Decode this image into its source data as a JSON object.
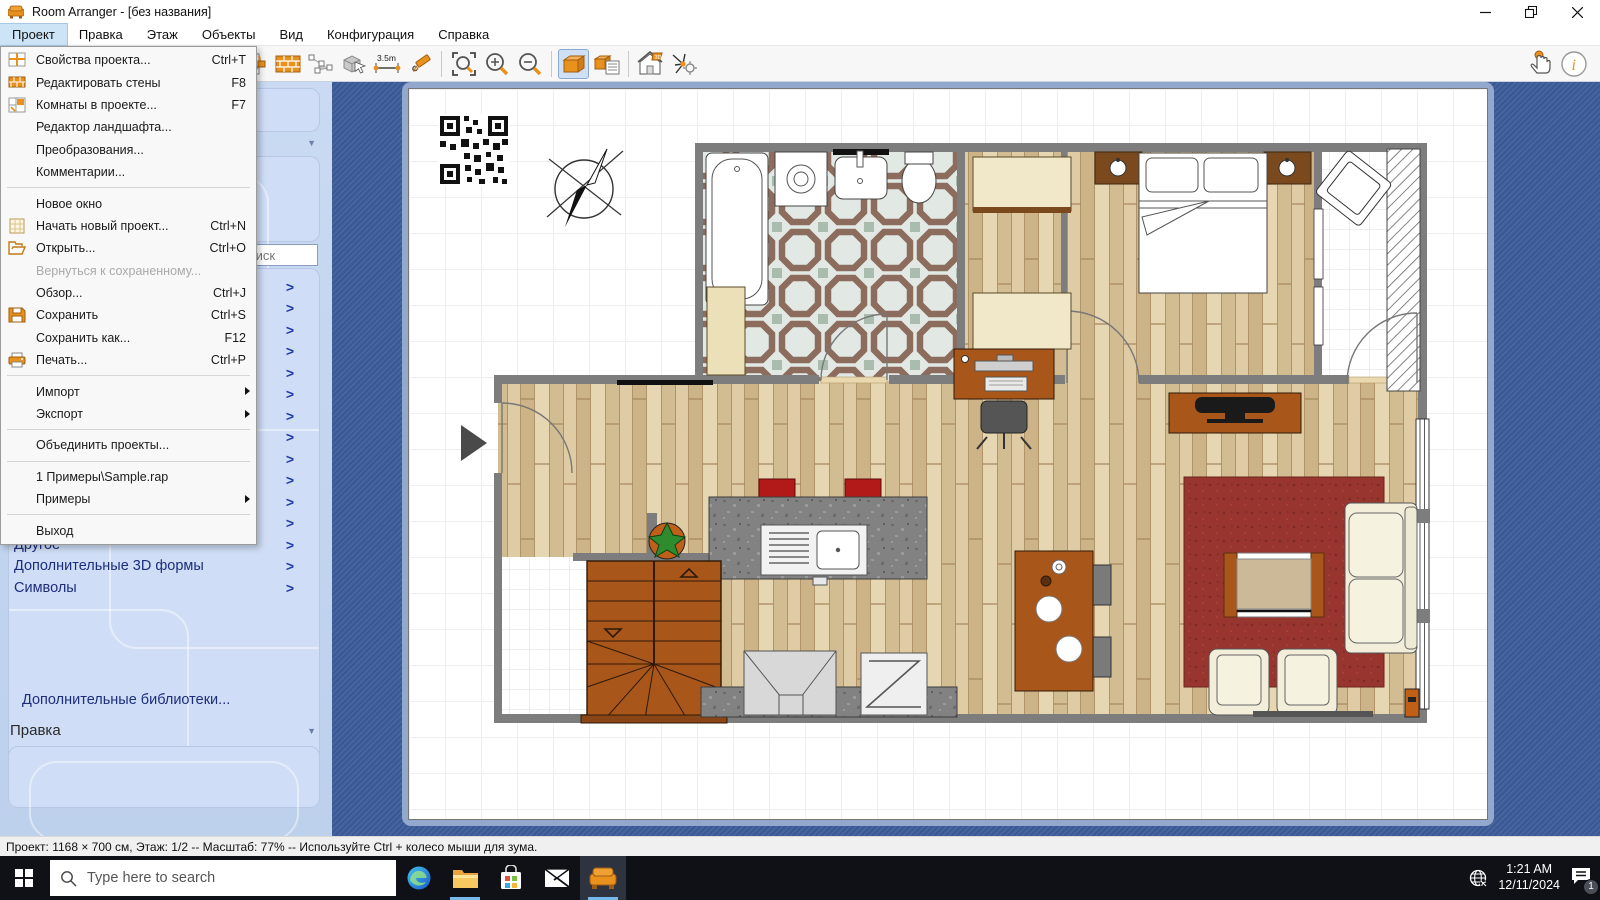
{
  "window": {
    "title": "Room Arranger - [без названия]"
  },
  "menubar": {
    "items": [
      {
        "label": "Проект",
        "active": true
      },
      {
        "label": "Правка"
      },
      {
        "label": "Этаж"
      },
      {
        "label": "Объекты"
      },
      {
        "label": "Вид"
      },
      {
        "label": "Конфигурация"
      },
      {
        "label": "Справка"
      }
    ]
  },
  "project_menu": {
    "items": [
      {
        "label": "Свойства проекта...",
        "shortcut": "Ctrl+T",
        "icon": "project-properties-icon"
      },
      {
        "label": "Редактировать стены",
        "shortcut": "F8",
        "icon": "edit-walls-icon"
      },
      {
        "label": "Комнаты в проекте...",
        "shortcut": "F7",
        "icon": "rooms-icon"
      },
      {
        "label": "Редактор ландшафта...",
        "shortcut": ""
      },
      {
        "label": "Преобразования...",
        "shortcut": ""
      },
      {
        "label": "Комментарии...",
        "shortcut": ""
      },
      {
        "label": "Новое окно",
        "shortcut": ""
      },
      {
        "label": "Начать новый проект...",
        "shortcut": "Ctrl+N",
        "icon": "new-project-icon"
      },
      {
        "label": "Открыть...",
        "shortcut": "Ctrl+O",
        "icon": "open-icon"
      },
      {
        "label": "Вернуться к сохраненному...",
        "shortcut": "",
        "disabled": true
      },
      {
        "label": "Обзор...",
        "shortcut": "Ctrl+J"
      },
      {
        "label": "Сохранить",
        "shortcut": "Ctrl+S",
        "icon": "save-icon"
      },
      {
        "label": "Сохранить как...",
        "shortcut": "F12"
      },
      {
        "label": "Печать...",
        "shortcut": "Ctrl+P",
        "icon": "print-icon"
      },
      {
        "label": "Импорт",
        "submenu": true
      },
      {
        "label": "Экспорт",
        "submenu": true
      },
      {
        "label": "Объединить проекты...",
        "shortcut": ""
      },
      {
        "label": "1 Примеры\\Sample.rap",
        "shortcut": ""
      },
      {
        "label": "Примеры",
        "submenu": true
      },
      {
        "label": "Выход",
        "shortcut": ""
      }
    ]
  },
  "toolbar": {
    "measure_label": "3.5m",
    "buttons": [
      "door",
      "edit-walls",
      "select-nodes",
      "move-object-3d",
      "measure",
      "draw",
      "zoom-fit",
      "zoom-in",
      "zoom-out",
      "view-3d",
      "object-list-3d",
      "walkthrough",
      "render-settings",
      "hand-pointer",
      "info"
    ]
  },
  "sidebar": {
    "search_placeholder": "Поиск",
    "hidden_rows": 12,
    "items": [
      {
        "label": "Другое"
      },
      {
        "label": "Дополнительные 3D формы"
      },
      {
        "label": "Символы"
      }
    ],
    "more_link": "Дополнительные библиотеки...",
    "section_edit": "Правка"
  },
  "statusbar": {
    "text": "Проект: 1168 × 700 см, Этаж: 1/2 -- Масштаб: 77% -- Используйте Ctrl + колесо мыши для зума."
  },
  "taskbar": {
    "search_placeholder": "Type here to search",
    "time": "1:21 AM",
    "date": "12/11/2024",
    "notification_count": "1"
  },
  "colors": {
    "accent_orange": "#e8921d",
    "sidebar_blue": "#cfdef6",
    "canvas_blue": "#3c5c99",
    "selected_tool": "#cfe0f4",
    "wall_gray": "#7d7d7d",
    "rug_red": "#98352f",
    "stairs_brown": "#a9561b"
  }
}
